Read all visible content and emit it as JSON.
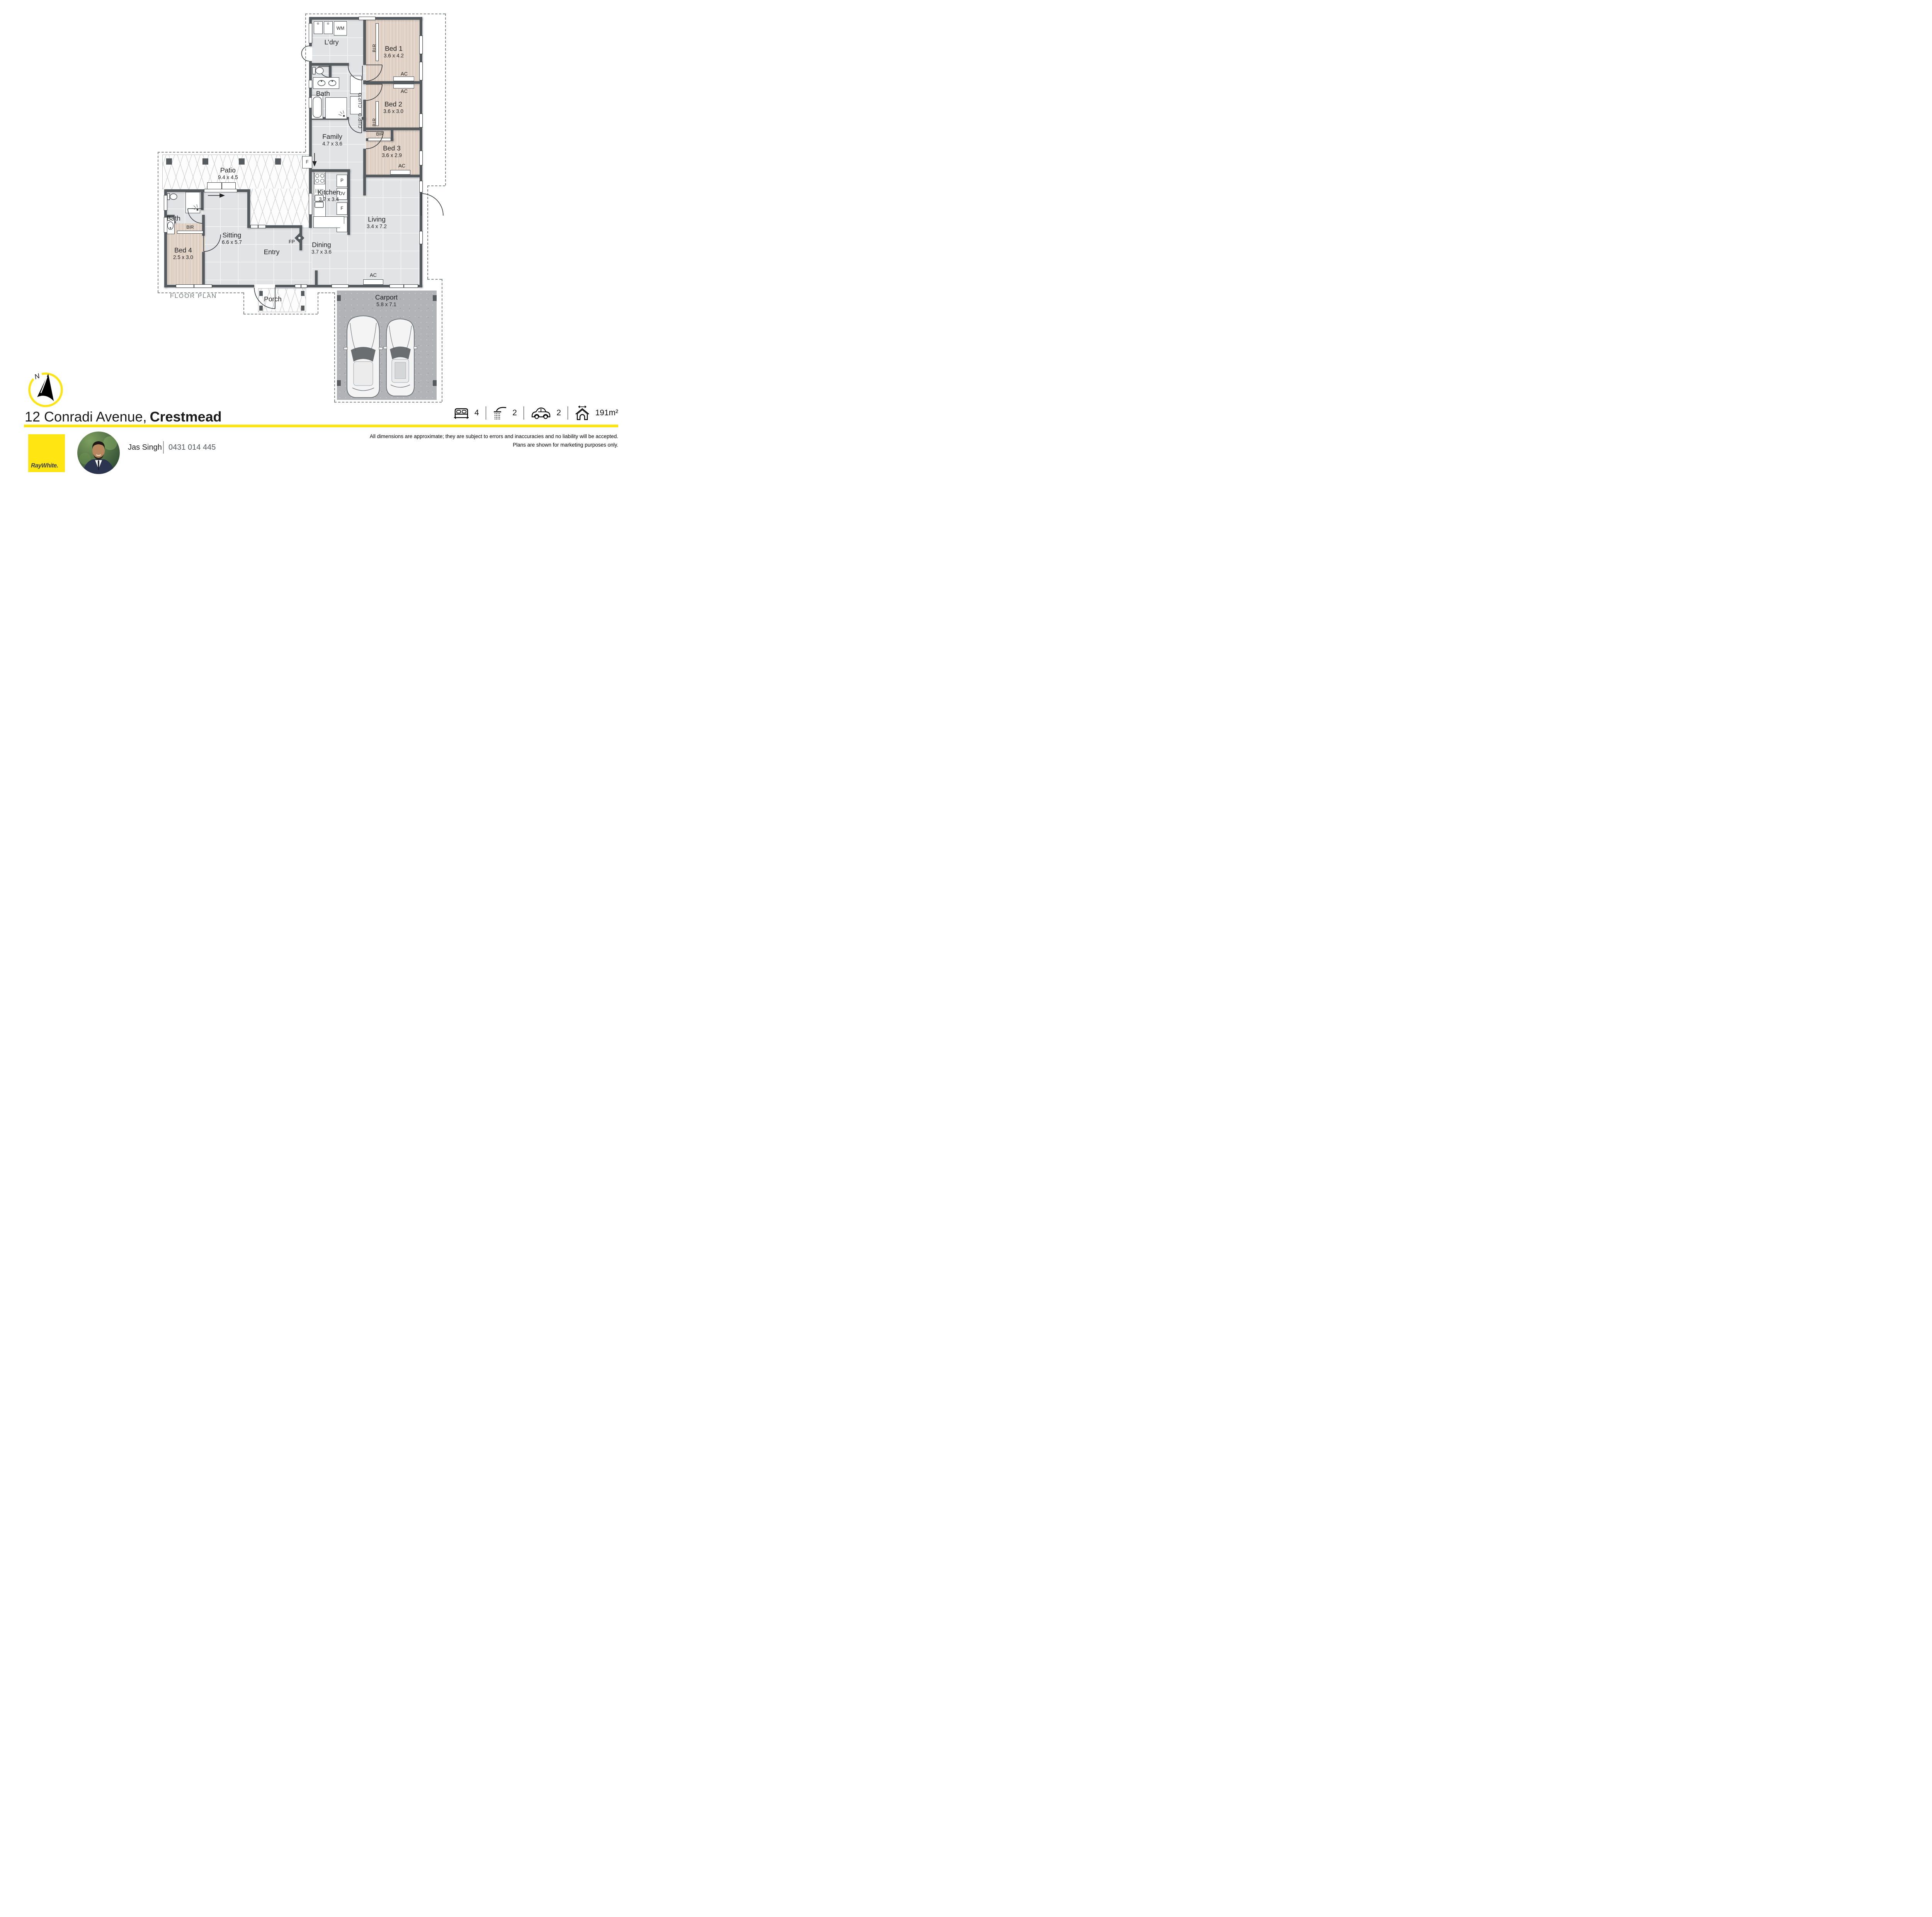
{
  "floor_plan": {
    "label": "FLOOR PLAN",
    "compass_label": "N",
    "rooms": {
      "ldry": {
        "name": "L’dry",
        "dims": ""
      },
      "bed1": {
        "name": "Bed 1",
        "dims": "3.6 x 4.2"
      },
      "bath1": {
        "name": "Bath",
        "dims": ""
      },
      "bed2": {
        "name": "Bed 2",
        "dims": "3.6 x 3.0"
      },
      "family": {
        "name": "Family",
        "dims": "4.7 x 3.6"
      },
      "bed3": {
        "name": "Bed 3",
        "dims": "3.6 x 2.9"
      },
      "patio": {
        "name": "Patio",
        "dims": "9.4 x 4.5"
      },
      "kitchen": {
        "name": "Kitchen",
        "dims": "3.7 x 3.4"
      },
      "living": {
        "name": "Living",
        "dims": "3.4 x 7.2"
      },
      "bath2": {
        "name": "Bath",
        "dims": ""
      },
      "bed4": {
        "name": "Bed 4",
        "dims": "2.5 x 3.0"
      },
      "sitting": {
        "name": "Sitting",
        "dims": "6.6 x 5.7"
      },
      "entry": {
        "name": "Entry",
        "dims": ""
      },
      "dining": {
        "name": "Dining",
        "dims": "3.7 x 3.6"
      },
      "porch": {
        "name": "Porch",
        "dims": ""
      },
      "carport": {
        "name": "Carport",
        "dims": "5.8 x 7.1"
      }
    },
    "fixtures": {
      "wm": "WM",
      "bir": "BIR",
      "cupd": "CUP’D",
      "ac": "AC",
      "fp": "FP",
      "p": "P",
      "ov": "OV",
      "f": "F"
    }
  },
  "address": {
    "street": "12 Conradi Avenue,",
    "suburb": "Crestmead"
  },
  "summary": {
    "beds": "4",
    "showers": "2",
    "cars": "2",
    "area": "191m²"
  },
  "agent": {
    "name": "Jas Singh",
    "phone": "0431 014 445"
  },
  "brand": {
    "logo_text": "RayWhite.",
    "yellow": "#ffe512"
  },
  "disclaimer": {
    "line1": "All dimensions are approximate; they are subject to errors and inaccuracies and no liability will be accepted.",
    "line2": "Plans are shown for marketing purposes only."
  }
}
